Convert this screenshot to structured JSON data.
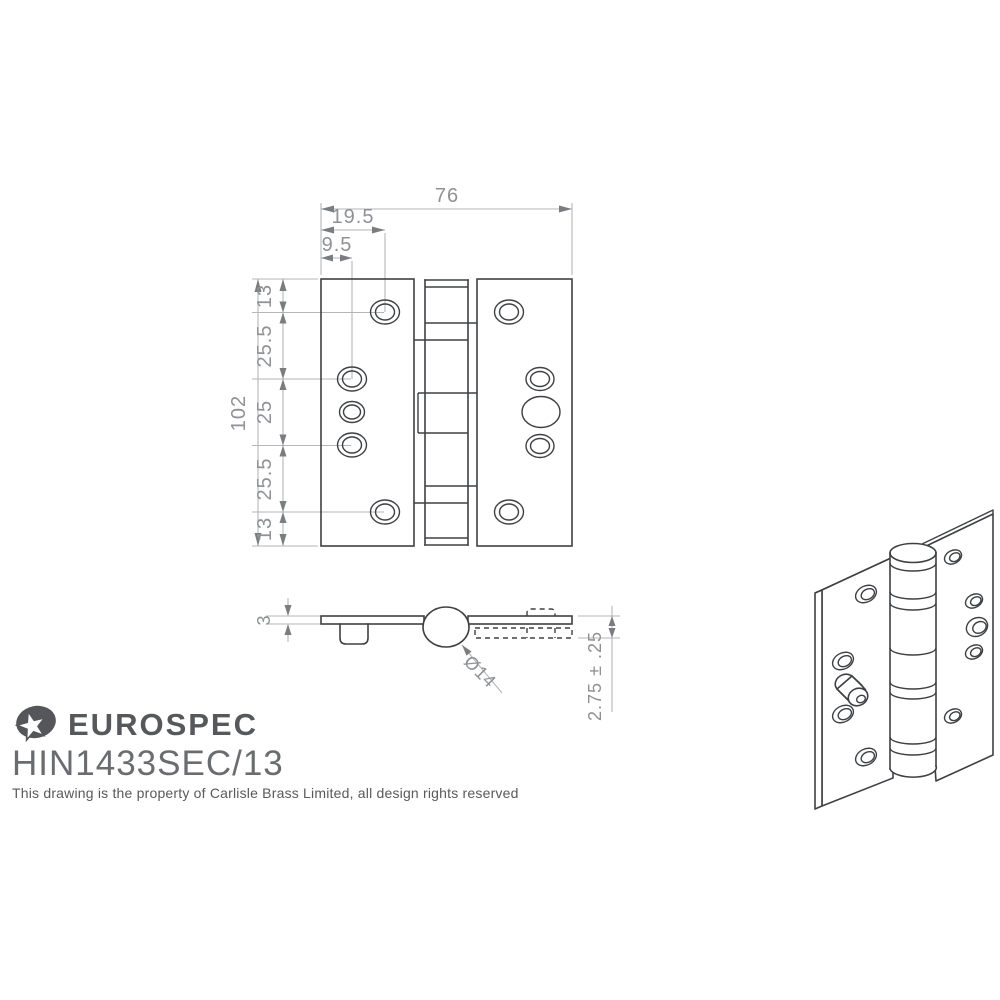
{
  "document_type": "hinge technical drawing",
  "title_block": {
    "brand": "EUROSPEC",
    "logo_icon": "star-in-ellipse-icon",
    "product_code": "HIN1433SEC/13",
    "copyright_note": "This drawing is the property of Carlisle Brass Limited, all design rights reserved"
  },
  "front_view": {
    "name": "front elevation of security hinge",
    "overall_width": "76",
    "hole_offset_outer": "19.5",
    "hole_offset_inner": "9.5",
    "overall_height": "102",
    "vertical_chain": [
      "13",
      "25.5",
      "25",
      "25.5",
      "13"
    ],
    "features": {
      "left_leaf_holes": 5,
      "right_leaf_holes": 5,
      "knuckles": 5
    }
  },
  "section_view": {
    "name": "plan section through closed hinge",
    "leaf_thickness": "3",
    "knuckle_diameter": "Ø14",
    "closed_thickness": "2.75 ± .25"
  },
  "isometric_view": {
    "name": "3D line rendering of hinge with security stud"
  },
  "colors": {
    "background": "#ffffff",
    "object_line": "#3e4043",
    "dimension_line": "#b4b6b8",
    "dimension_text": "#8f9194",
    "brand_text": "#57585c",
    "code_text": "#6b6c70"
  }
}
